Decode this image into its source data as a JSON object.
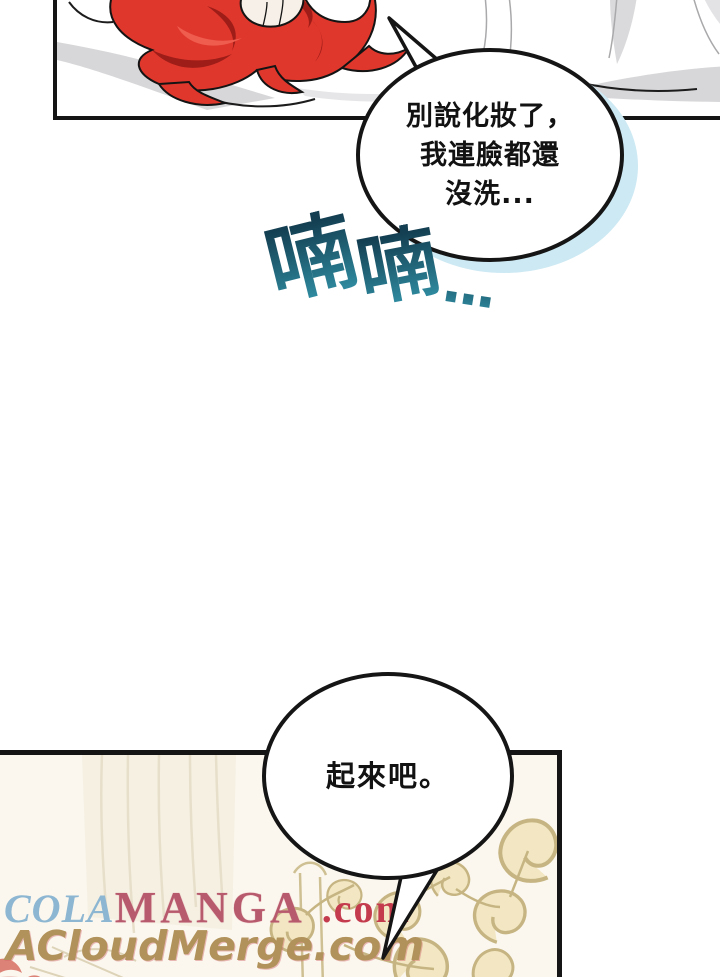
{
  "page": {
    "background": "#ffffff"
  },
  "bubble1": {
    "line1": "別說化妝了，",
    "line2": "我連臉都還",
    "line3": "沒洗..."
  },
  "sfx": {
    "char1": "喃",
    "char2": "喃",
    "dots": "..."
  },
  "bubble2": {
    "text": "起來吧。"
  },
  "watermarks": {
    "cola": "COLA",
    "manga": "MANGA",
    "com": ".com",
    "acloudmerge": "ACloudMerge.com"
  },
  "colors": {
    "panel_border": "#151515",
    "bubble_outline": "#151515",
    "bubble_shadow_blue": "#cde9f3",
    "hair_red": "#e0372c",
    "hair_shadow_red": "#9e1d18",
    "bedding_gray": "#d7d7d9",
    "sfx_teal_dark": "#143f52",
    "sfx_teal_light": "#2f8ba0",
    "panel2_background": "#fbf7ee",
    "ornament_beige": "#c6b583",
    "watermark_cola_blue": "#8db6d2",
    "watermark_manga_rose": "#b85a6d",
    "watermark_com_red": "#c43b4e",
    "watermark_acloud_tan": "#b0925a"
  }
}
